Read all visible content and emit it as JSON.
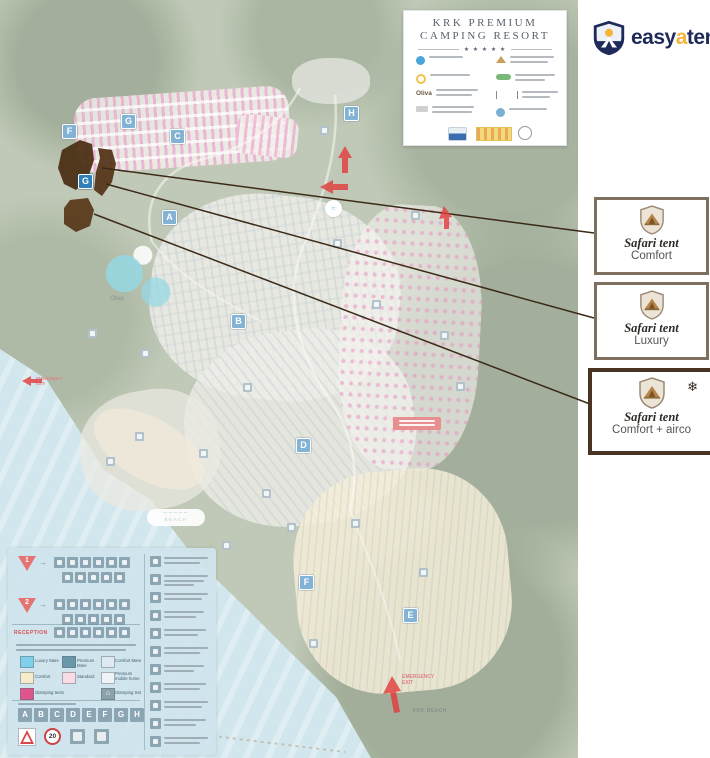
{
  "title_card": {
    "line1": "KRK PREMIUM",
    "line2": "CAMPING RESORT",
    "stars": "★ ★ ★ ★ ★",
    "oliva": "Oliva"
  },
  "brand": {
    "easy": "easy",
    "a": "a",
    "tent": "tent"
  },
  "icons": {
    "snowflake": "❄",
    "house": "⌂",
    "wave": "~~~~~"
  },
  "tent_boxes": [
    {
      "title": "Safari tent",
      "subtitle": "Comfort"
    },
    {
      "title": "Safari tent",
      "subtitle": "Luxury"
    },
    {
      "title": "Safari tent",
      "subtitle": "Comfort + airco"
    }
  ],
  "map": {
    "zone_badges": [
      "F",
      "G",
      "C",
      "H",
      "A",
      "B",
      "D",
      "E",
      "F",
      "G"
    ],
    "beach_marker_label": "BEACH",
    "emergency_exit_left": "EMERGENCY EXIT",
    "emergency_exit_bottom": "EMERGENCY EXIT",
    "fkk_beach_label": "FKK BEACH",
    "oliva_label": "Oliva"
  },
  "legend": {
    "marker_1": "1",
    "marker_2": "2",
    "reception_label": "RECEPTION",
    "zones": [
      {
        "label": "Luxury Mare",
        "color": "#7fd0e8"
      },
      {
        "label": "Premium Mare",
        "color": "#6a98ab"
      },
      {
        "label": "Comfort Mare",
        "color": "#dfe9f2"
      },
      {
        "label": "Comfort",
        "color": "#f6eccb"
      },
      {
        "label": "Standard",
        "color": "#f8dbe3"
      },
      {
        "label": "Premium mobile home",
        "color": "#eff3f6"
      },
      {
        "label": "Glamping tents",
        "color": "#e0568c"
      },
      {
        "label": "Glamping Set",
        "color": "#8ba2ae"
      }
    ],
    "letters": [
      "A",
      "B",
      "C",
      "D",
      "E",
      "F",
      "G",
      "H"
    ],
    "speed_limit": "20"
  },
  "colors": {
    "brand_navy": "#1e2a5a",
    "brand_yellow": "#f5b53a",
    "box_border": "#7e6f5e",
    "box3_border": "#4a3424",
    "highlight_zone": "#4b3015",
    "sea": "#b4d8e2"
  }
}
